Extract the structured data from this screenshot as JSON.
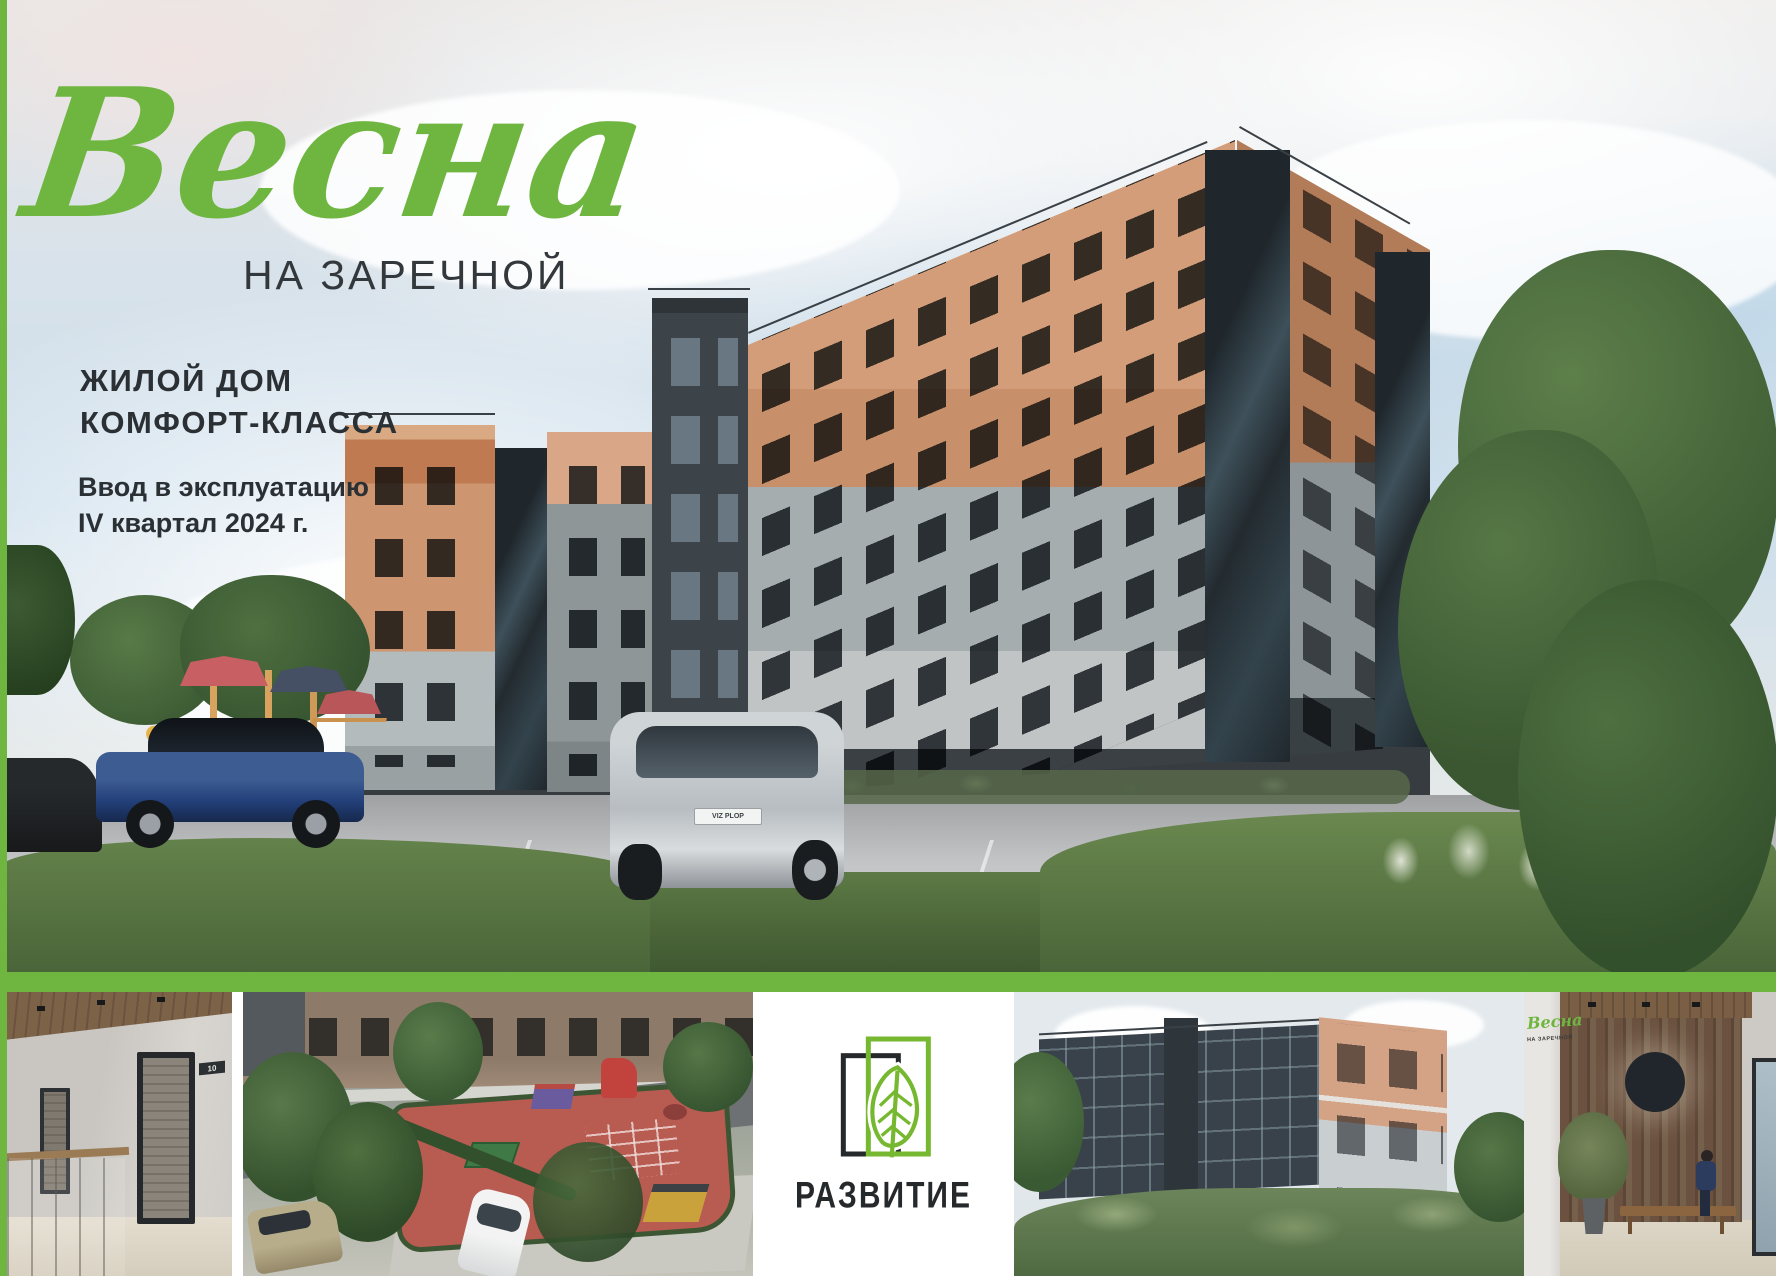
{
  "colors": {
    "brand_green": "#6fb640",
    "logo_green": "#76b82f",
    "text_dark": "#2b3035"
  },
  "hero": {
    "title_script": "Весна",
    "title_sub": "НА ЗАРЕЧНОЙ",
    "tagline_line1": "ЖИЛОЙ ДОМ",
    "tagline_line2": "КОМФОРТ-КЛАССА",
    "delivery_line1": "Ввод в эксплуатацию",
    "delivery_line2": "IV квартал 2024 г.",
    "car_plate": "VIZ PLOP"
  },
  "strip": {
    "hallway": {
      "door_number": "10"
    },
    "developer_name": "РАЗВИТИЕ",
    "lobby": {
      "sign_script": "Весна",
      "sign_sub": "НА ЗАРЕЧНОЙ"
    }
  }
}
